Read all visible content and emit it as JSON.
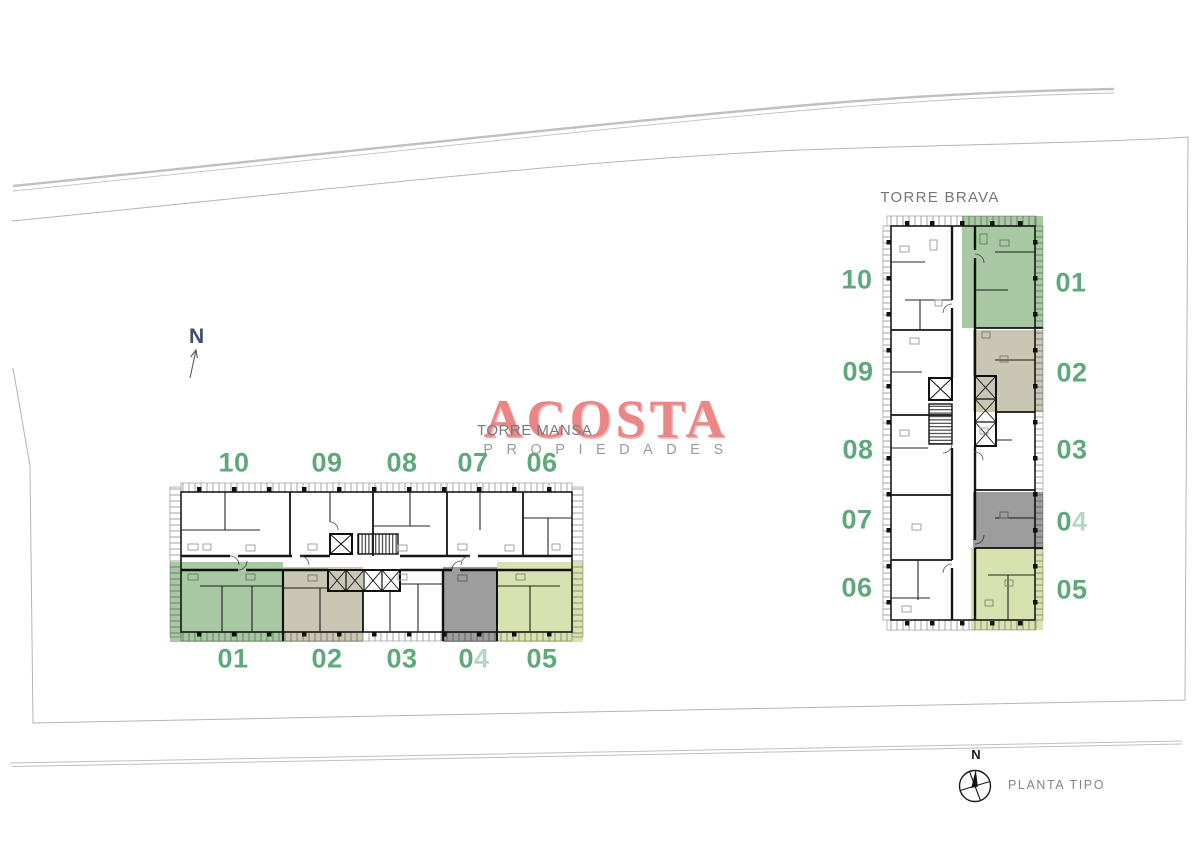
{
  "watermark": {
    "title": "ACOSTA",
    "subtitle": "PROPIEDADES",
    "title_color": "#eb8686",
    "subtitle_color": "#9b9b9b"
  },
  "torre_mansa": {
    "title": "TORRE MANSA",
    "top_units": [
      "10",
      "09",
      "08",
      "07",
      "06"
    ],
    "bottom_units": [
      "01",
      "02",
      "03",
      "04",
      "05"
    ]
  },
  "torre_brava": {
    "title": "TORRE BRAVA",
    "left_units": [
      "10",
      "09",
      "08",
      "07",
      "06"
    ],
    "right_units": [
      "01",
      "02",
      "03",
      "04",
      "05"
    ]
  },
  "site": {
    "north_label": "N"
  },
  "legend": {
    "north_label": "N",
    "caption": "PLANTA TIPO"
  },
  "colors": {
    "unit_number_green": "#5ea87b",
    "unit_01_overlay": "#a8c8a3",
    "unit_02_overlay": "#c9c6b4",
    "unit_04_overlay": "#9d9d9d",
    "unit_05_overlay": "#d8e1b0",
    "plan_wall": "#1b1b1b",
    "boundary_line": "#b6b6ba"
  }
}
